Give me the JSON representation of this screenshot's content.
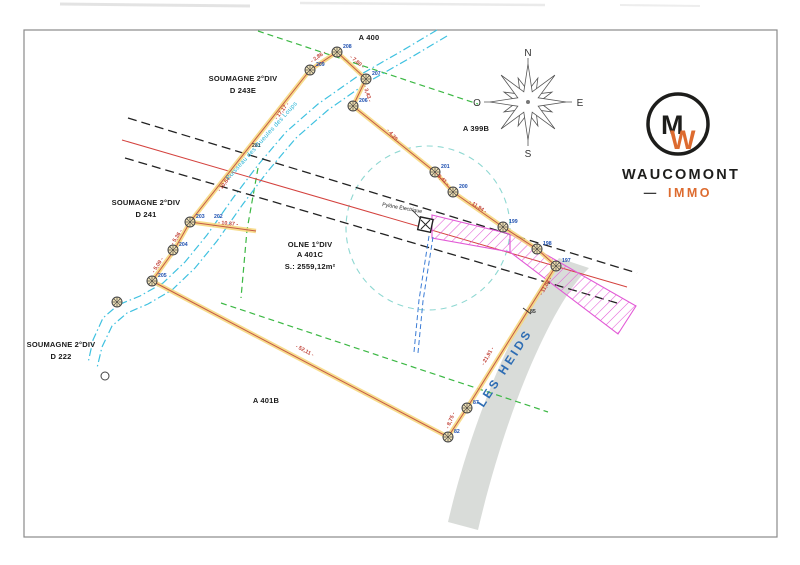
{
  "document_type": "survey-plan",
  "region_labels": {
    "a400": {
      "text": "A 400"
    },
    "a399b": {
      "text": "A 399B"
    },
    "a401b": {
      "text": "A 401B"
    },
    "soumagne_243e": {
      "line1": "SOUMAGNE 2°DIV",
      "line2": "D 243E"
    },
    "soumagne_241": {
      "line1": "SOUMAGNE 2°DIV",
      "line2": "D 241"
    },
    "soumagne_222": {
      "line1": "SOUMAGNE 2°DIV",
      "line2": "D 222"
    },
    "olne": {
      "line1": "OLNE 1°DIV",
      "line2": "A 401C",
      "line3": "S.: 2559,12m²"
    }
  },
  "road": {
    "name": "LES HEIDS",
    "color": "#2e6db4"
  },
  "stream": {
    "name": "Ruisseau des Gueules des Loups",
    "color": "#2ab5d6"
  },
  "pylon": {
    "label": "Pylône Électrique"
  },
  "compass": {
    "north": "N",
    "south": "S",
    "east": "E",
    "west": "O"
  },
  "logo": {
    "brand": "WAUCOMONT",
    "dash": "—",
    "suffix": "IMMO",
    "monogram_m": "M",
    "monogram_w": "W",
    "accent_color": "#dd6b2f",
    "ink_color": "#1d1d1b"
  },
  "measurements": [
    {
      "value": "2,86",
      "x": 319,
      "y": 58,
      "rot": -35
    },
    {
      "value": "7,80",
      "x": 356,
      "y": 63,
      "rot": 40
    },
    {
      "value": "3,43",
      "x": 366,
      "y": 94,
      "rot": 72
    },
    {
      "value": "4,35",
      "x": 392,
      "y": 137,
      "rot": 50
    },
    {
      "value": "8,41",
      "x": 441,
      "y": 180,
      "rot": 43
    },
    {
      "value": "11,94",
      "x": 477,
      "y": 208,
      "rot": 33
    },
    {
      "value": "11,04",
      "x": 547,
      "y": 287,
      "rot": -60
    },
    {
      "value": "21,91",
      "x": 489,
      "y": 357,
      "rot": -60
    },
    {
      "value": "8,75",
      "x": 452,
      "y": 421,
      "rot": -68
    },
    {
      "value": "52,11",
      "x": 304,
      "y": 352,
      "rot": 28
    },
    {
      "value": "17,17",
      "x": 283,
      "y": 112,
      "rot": -52
    },
    {
      "value": "10,64",
      "x": 226,
      "y": 184,
      "rot": -52
    },
    {
      "value": "10,37",
      "x": 228,
      "y": 225,
      "rot": 5
    },
    {
      "value": "5,36",
      "x": 178,
      "y": 238,
      "rot": -57
    },
    {
      "value": "5,09",
      "x": 159,
      "y": 266,
      "rot": -57
    }
  ],
  "survey_points": [
    {
      "label": "209",
      "x": 310,
      "y": 70
    },
    {
      "label": "208",
      "x": 337,
      "y": 52
    },
    {
      "label": "207",
      "x": 366,
      "y": 79
    },
    {
      "label": "206",
      "x": 353,
      "y": 106
    },
    {
      "label": "201",
      "x": 435,
      "y": 172
    },
    {
      "label": "200",
      "x": 453,
      "y": 192
    },
    {
      "label": "199",
      "x": 503,
      "y": 227
    },
    {
      "label": "198",
      "x": 537,
      "y": 249
    },
    {
      "label": "197",
      "x": 556,
      "y": 266
    },
    {
      "label": "87",
      "x": 467,
      "y": 408
    },
    {
      "label": "82",
      "x": 448,
      "y": 437
    },
    {
      "label": "205",
      "x": 152,
      "y": 281
    },
    {
      "label": "204",
      "x": 173,
      "y": 250
    },
    {
      "label": "203",
      "x": 190,
      "y": 222
    },
    {
      "label": "",
      "x": 117,
      "y": 302
    }
  ],
  "extra_labels": [
    {
      "text": "281",
      "x": 252,
      "y": 147,
      "color": "dark"
    },
    {
      "text": "202",
      "x": 214,
      "y": 218,
      "color": "blue"
    },
    {
      "text": "85",
      "x": 530,
      "y": 313,
      "color": "dark"
    }
  ],
  "colors": {
    "boundary_fill": "#f6d678",
    "boundary_line": "#bf4a3e",
    "measure_text": "#c2453b",
    "point_text": "#1d4fb0",
    "stream_line": "#3fc1e0",
    "green_dashed": "#3cb844",
    "black_dashed": "#222222",
    "red_line": "#d4423e",
    "servitude_pink": "#e25ad6",
    "circle_teal": "#8fd8d2",
    "road_gray": "#d7dad7",
    "electric_blue": "#3a7bd5"
  }
}
